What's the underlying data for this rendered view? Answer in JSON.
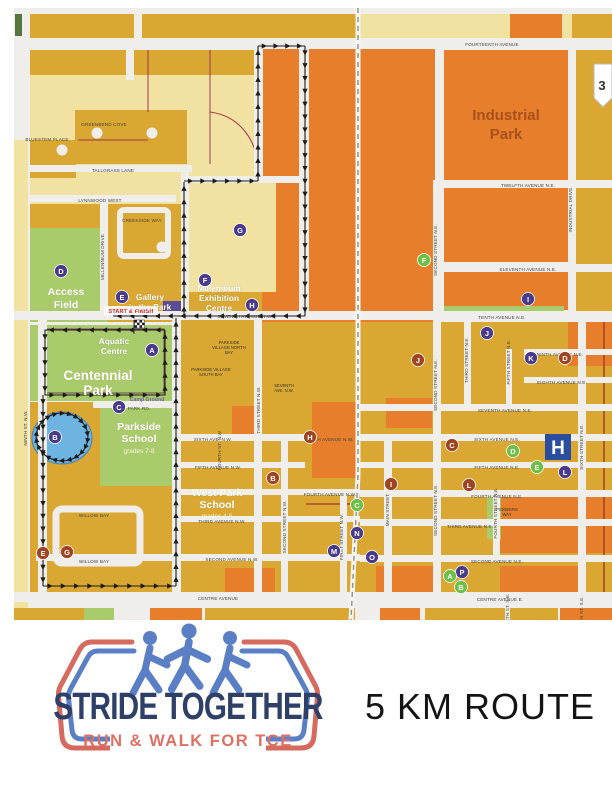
{
  "colors": {
    "purple_marker": "#4a3a8c",
    "green_marker": "#6cbf47",
    "brown_marker": "#9e4423",
    "hospital_blue": "#2a4da0",
    "route_black": "#1c1c1c",
    "cream": "#f1e2a2",
    "gold": "#d9a732",
    "orange": "#e67e2b",
    "park_green": "#a9cb6b",
    "lake_blue": "#6db4e2",
    "logo_navy": "#2e3f68",
    "logo_red": "#d66a5f",
    "logo_blue": "#5b7fc4",
    "start_red": "#cc2327"
  },
  "map": {
    "start_finish": "START & FINISH",
    "shield": "3",
    "streets": [
      {
        "t": "FOURTEENTH AVENUE",
        "x": 492,
        "y": 46,
        "r": 0
      },
      {
        "t": "TWELFTH AVENUE N.E.",
        "x": 528,
        "y": 187,
        "r": 0
      },
      {
        "t": "ELEVENTH AVENUE N.E.",
        "x": 528,
        "y": 271,
        "r": 0
      },
      {
        "t": "TENTH AVENUE N.E.",
        "x": 502,
        "y": 319,
        "r": 0
      },
      {
        "t": "NINTH AVENUE N.E.",
        "x": 560,
        "y": 356,
        "r": 0
      },
      {
        "t": "EIGHTH AVENUE N.E.",
        "x": 562,
        "y": 384,
        "r": 0
      },
      {
        "t": "SEVENTH AVENUE N.E.",
        "x": 505,
        "y": 412,
        "r": 0
      },
      {
        "t": "SIXTH AVENUE N.E.",
        "x": 497,
        "y": 441,
        "r": 0
      },
      {
        "t": "FIFTH AVENUE N.E.",
        "x": 497,
        "y": 469,
        "r": 0
      },
      {
        "t": "FOURTH AVENUE N.E.",
        "x": 497,
        "y": 498,
        "r": 0
      },
      {
        "t": "THIRD AVENUE N.E.",
        "x": 470,
        "y": 528,
        "r": 0
      },
      {
        "t": "SECOND AVENUE N.E.",
        "x": 497,
        "y": 563,
        "r": 0
      },
      {
        "t": "CENTRE AVENUE E.",
        "x": 500,
        "y": 601,
        "r": 0
      },
      {
        "t": "CENTRE AVENUE",
        "x": 218,
        "y": 600,
        "r": 0
      },
      {
        "t": "SECOND AVENUE N.W.",
        "x": 232,
        "y": 561,
        "r": 0
      },
      {
        "t": "THIRD AVENUE N.W.",
        "x": 222,
        "y": 523,
        "r": 0
      },
      {
        "t": "FOURTH AVENUE N.W.",
        "x": 330,
        "y": 496,
        "r": 0
      },
      {
        "t": "FIFTH AVENUE N.W.",
        "x": 218,
        "y": 469,
        "r": 0
      },
      {
        "t": "SIXTH AVE. N.W.",
        "x": 213,
        "y": 441,
        "r": 0
      },
      {
        "t": "SIXTH AVENUE N.W.",
        "x": 330,
        "y": 441,
        "r": 0
      },
      {
        "t": "SEVENTH AVENUE N.W.",
        "x": 245,
        "y": 318,
        "r": 0
      },
      {
        "t": "PARK RD.",
        "x": 139,
        "y": 410,
        "r": 0
      },
      {
        "t": "WILLOW BAY",
        "x": 94,
        "y": 517,
        "r": 0
      },
      {
        "t": "WILLOW BAY",
        "x": 94,
        "y": 563,
        "r": 0
      },
      {
        "t": "LYNNWOOD WEST",
        "x": 100,
        "y": 202,
        "r": 0
      },
      {
        "t": "TALLGRASS LANE",
        "x": 113,
        "y": 172,
        "r": 0
      },
      {
        "t": "GREENBEND COVE",
        "x": 104,
        "y": 126,
        "r": 0
      },
      {
        "t": "BLUESTEM PLACE",
        "x": 47,
        "y": 141,
        "r": 0
      },
      {
        "t": "CREEKSIDE WAY",
        "x": 142,
        "y": 222,
        "r": 0
      },
      {
        "t": "NINTH ST. N.W.",
        "x": 27,
        "y": 428,
        "r": 1
      },
      {
        "t": "MILLENNIUM DRIVE",
        "x": 104,
        "y": 257,
        "r": 1
      },
      {
        "t": "FOURTH ST. N.W.",
        "x": 221,
        "y": 450,
        "r": 1
      },
      {
        "t": "THIRD STREET N.W.",
        "x": 260,
        "y": 410,
        "r": 1
      },
      {
        "t": "SECOND STREET N.W.",
        "x": 286,
        "y": 527,
        "r": 1
      },
      {
        "t": "FIRST STREET N.W.",
        "x": 343,
        "y": 537,
        "r": 1
      },
      {
        "t": "MAIN STREET",
        "x": 389,
        "y": 510,
        "r": 1
      },
      {
        "t": "SECOND STREET N.E.",
        "x": 437,
        "y": 250,
        "r": 1
      },
      {
        "t": "SECOND STREET N.E.",
        "x": 437,
        "y": 385,
        "r": 1
      },
      {
        "t": "SECOND STREET N.E.",
        "x": 437,
        "y": 510,
        "r": 1
      },
      {
        "t": "THIRD STREET N.E.",
        "x": 468,
        "y": 360,
        "r": 1
      },
      {
        "t": "FIFTH STREET N.E.",
        "x": 510,
        "y": 362,
        "r": 1
      },
      {
        "t": "FOURTH STREET N.E.",
        "x": 497,
        "y": 513,
        "r": 1
      },
      {
        "t": "SIXTH STREET N.E.",
        "x": 583,
        "y": 447,
        "r": 1
      },
      {
        "t": "INDUSTRIAL DRIVE",
        "x": 572,
        "y": 210,
        "r": 1
      },
      {
        "t": "FOURTH ST. S.E.",
        "x": 509,
        "y": 613,
        "r": 1
      },
      {
        "t": "SIXTH ST. S.E.",
        "x": 583,
        "y": 613,
        "r": 1
      }
    ],
    "places": [
      {
        "lines": [
          "Industrial",
          "Park"
        ],
        "x": 506,
        "y": 120,
        "cls": "pl-brown",
        "lh": 19
      },
      {
        "lines": [
          "Access",
          "Field"
        ],
        "x": 66,
        "y": 295,
        "cls": "pl-white-md",
        "lh": 13
      },
      {
        "lines": [
          "Gallery",
          "in the Park"
        ],
        "x": 150,
        "y": 300,
        "cls": "pl-white-sm",
        "lh": 10
      },
      {
        "lines": [
          "Millennium",
          "Exhibition",
          "Centre"
        ],
        "x": 219,
        "y": 291,
        "cls": "pl-white-sm",
        "lh": 10
      },
      {
        "lines": [
          "Aquatic",
          "Centre"
        ],
        "x": 114,
        "y": 344,
        "cls": "pl-white-sm",
        "lh": 10
      },
      {
        "lines": [
          "Centennial",
          "Park"
        ],
        "x": 98,
        "y": 380,
        "cls": "pl-white-lg",
        "lh": 15
      },
      {
        "lines": [
          "Parkside",
          "School"
        ],
        "x": 139,
        "y": 430,
        "cls": "pl-white-md",
        "lh": 12
      },
      {
        "lines": [
          "grades 7-8"
        ],
        "x": 139,
        "y": 453,
        "cls": "pl-grades",
        "lh": 7
      },
      {
        "lines": [
          "West Park",
          "School"
        ],
        "x": 217,
        "y": 496,
        "cls": "pl-white-md",
        "lh": 12
      },
      {
        "lines": [
          "grades 4-6"
        ],
        "x": 217,
        "y": 518,
        "cls": "pl-grades",
        "lh": 7
      },
      {
        "lines": [
          "PARKSIDE",
          "VILLAGE NORTH",
          "BAY"
        ],
        "x": 229,
        "y": 344,
        "cls": "pl-tiny",
        "lh": 5
      },
      {
        "lines": [
          "PARKSIDE VILLAGE",
          "SOUTH BAY"
        ],
        "x": 211,
        "y": 371,
        "cls": "pl-tiny",
        "lh": 5
      },
      {
        "lines": [
          "Camp Ground"
        ],
        "x": 147,
        "y": 401,
        "cls": "pl-camp",
        "lh": 6
      },
      {
        "lines": [
          "PIONEERS",
          "WAY"
        ],
        "x": 507,
        "y": 511,
        "cls": "pl-tiny",
        "lh": 5
      },
      {
        "lines": [
          "SEVENTH",
          "AVE. N.W."
        ],
        "x": 284,
        "y": 387,
        "cls": "pl-tiny",
        "lh": 5
      }
    ],
    "markers": [
      {
        "l": "A",
        "x": 152,
        "y": 350,
        "k": "purple"
      },
      {
        "l": "B",
        "x": 55,
        "y": 437,
        "k": "purple"
      },
      {
        "l": "C",
        "x": 119,
        "y": 407,
        "k": "purple"
      },
      {
        "l": "D",
        "x": 61,
        "y": 271,
        "k": "purple"
      },
      {
        "l": "E",
        "x": 122,
        "y": 297,
        "k": "purple"
      },
      {
        "l": "F",
        "x": 205,
        "y": 280,
        "k": "purple"
      },
      {
        "l": "G",
        "x": 240,
        "y": 230,
        "k": "purple"
      },
      {
        "l": "H",
        "x": 252,
        "y": 305,
        "k": "purple"
      },
      {
        "l": "I",
        "x": 528,
        "y": 299,
        "k": "purple"
      },
      {
        "l": "J",
        "x": 487,
        "y": 333,
        "k": "purple"
      },
      {
        "l": "K",
        "x": 531,
        "y": 358,
        "k": "purple"
      },
      {
        "l": "L",
        "x": 565,
        "y": 472,
        "k": "purple"
      },
      {
        "l": "M",
        "x": 334,
        "y": 551,
        "k": "purple"
      },
      {
        "l": "N",
        "x": 357,
        "y": 533,
        "k": "purple"
      },
      {
        "l": "O",
        "x": 372,
        "y": 557,
        "k": "purple"
      },
      {
        "l": "P",
        "x": 462,
        "y": 572,
        "k": "purple"
      },
      {
        "l": "F",
        "x": 424,
        "y": 260,
        "k": "green"
      },
      {
        "l": "C",
        "x": 357,
        "y": 505,
        "k": "green"
      },
      {
        "l": "A",
        "x": 450,
        "y": 576,
        "k": "green"
      },
      {
        "l": "B",
        "x": 461,
        "y": 587,
        "k": "green"
      },
      {
        "l": "D",
        "x": 513,
        "y": 451,
        "k": "green"
      },
      {
        "l": "E",
        "x": 537,
        "y": 467,
        "k": "green"
      },
      {
        "l": "B",
        "x": 273,
        "y": 478,
        "k": "brown"
      },
      {
        "l": "C",
        "x": 452,
        "y": 445,
        "k": "brown"
      },
      {
        "l": "D",
        "x": 565,
        "y": 358,
        "k": "brown"
      },
      {
        "l": "E",
        "x": 43,
        "y": 553,
        "k": "brown"
      },
      {
        "l": "G",
        "x": 67,
        "y": 552,
        "k": "brown"
      },
      {
        "l": "H",
        "x": 310,
        "y": 437,
        "k": "brown"
      },
      {
        "l": "I",
        "x": 391,
        "y": 484,
        "k": "brown"
      },
      {
        "l": "J",
        "x": 418,
        "y": 360,
        "k": "brown"
      },
      {
        "l": "L",
        "x": 469,
        "y": 485,
        "k": "brown"
      },
      {
        "l": "H",
        "x": 558,
        "y": 447,
        "k": "hospital"
      }
    ],
    "route": {
      "loops": [
        [
          [
            184,
            316
          ],
          [
            184,
            182
          ]
        ],
        [
          [
            184,
            181
          ],
          [
            258,
            181
          ]
        ],
        [
          [
            258,
            181
          ],
          [
            258,
            46
          ]
        ],
        [
          [
            258,
            46
          ],
          [
            305,
            46
          ]
        ],
        [
          [
            305,
            46
          ],
          [
            305,
            316
          ]
        ],
        [
          [
            305,
            316
          ],
          [
            113,
            316
          ]
        ],
        [
          [
            165,
            330
          ],
          [
            45,
            330
          ],
          [
            45,
            395
          ],
          [
            165,
            395
          ],
          [
            165,
            330
          ]
        ],
        [
          [
            43,
            395
          ],
          [
            43,
            586
          ]
        ],
        [
          [
            43,
            586
          ],
          [
            176,
            586
          ]
        ],
        [
          [
            176,
            586
          ],
          [
            176,
            318
          ]
        ]
      ],
      "circle": {
        "cx": 62,
        "cy": 437,
        "r": 26
      }
    }
  },
  "footer": {
    "logo_title": "STRIDE TOGETHER",
    "logo_tagline": "RUN & WALK FOR TCE",
    "route_label": "5 KM ROUTE"
  }
}
